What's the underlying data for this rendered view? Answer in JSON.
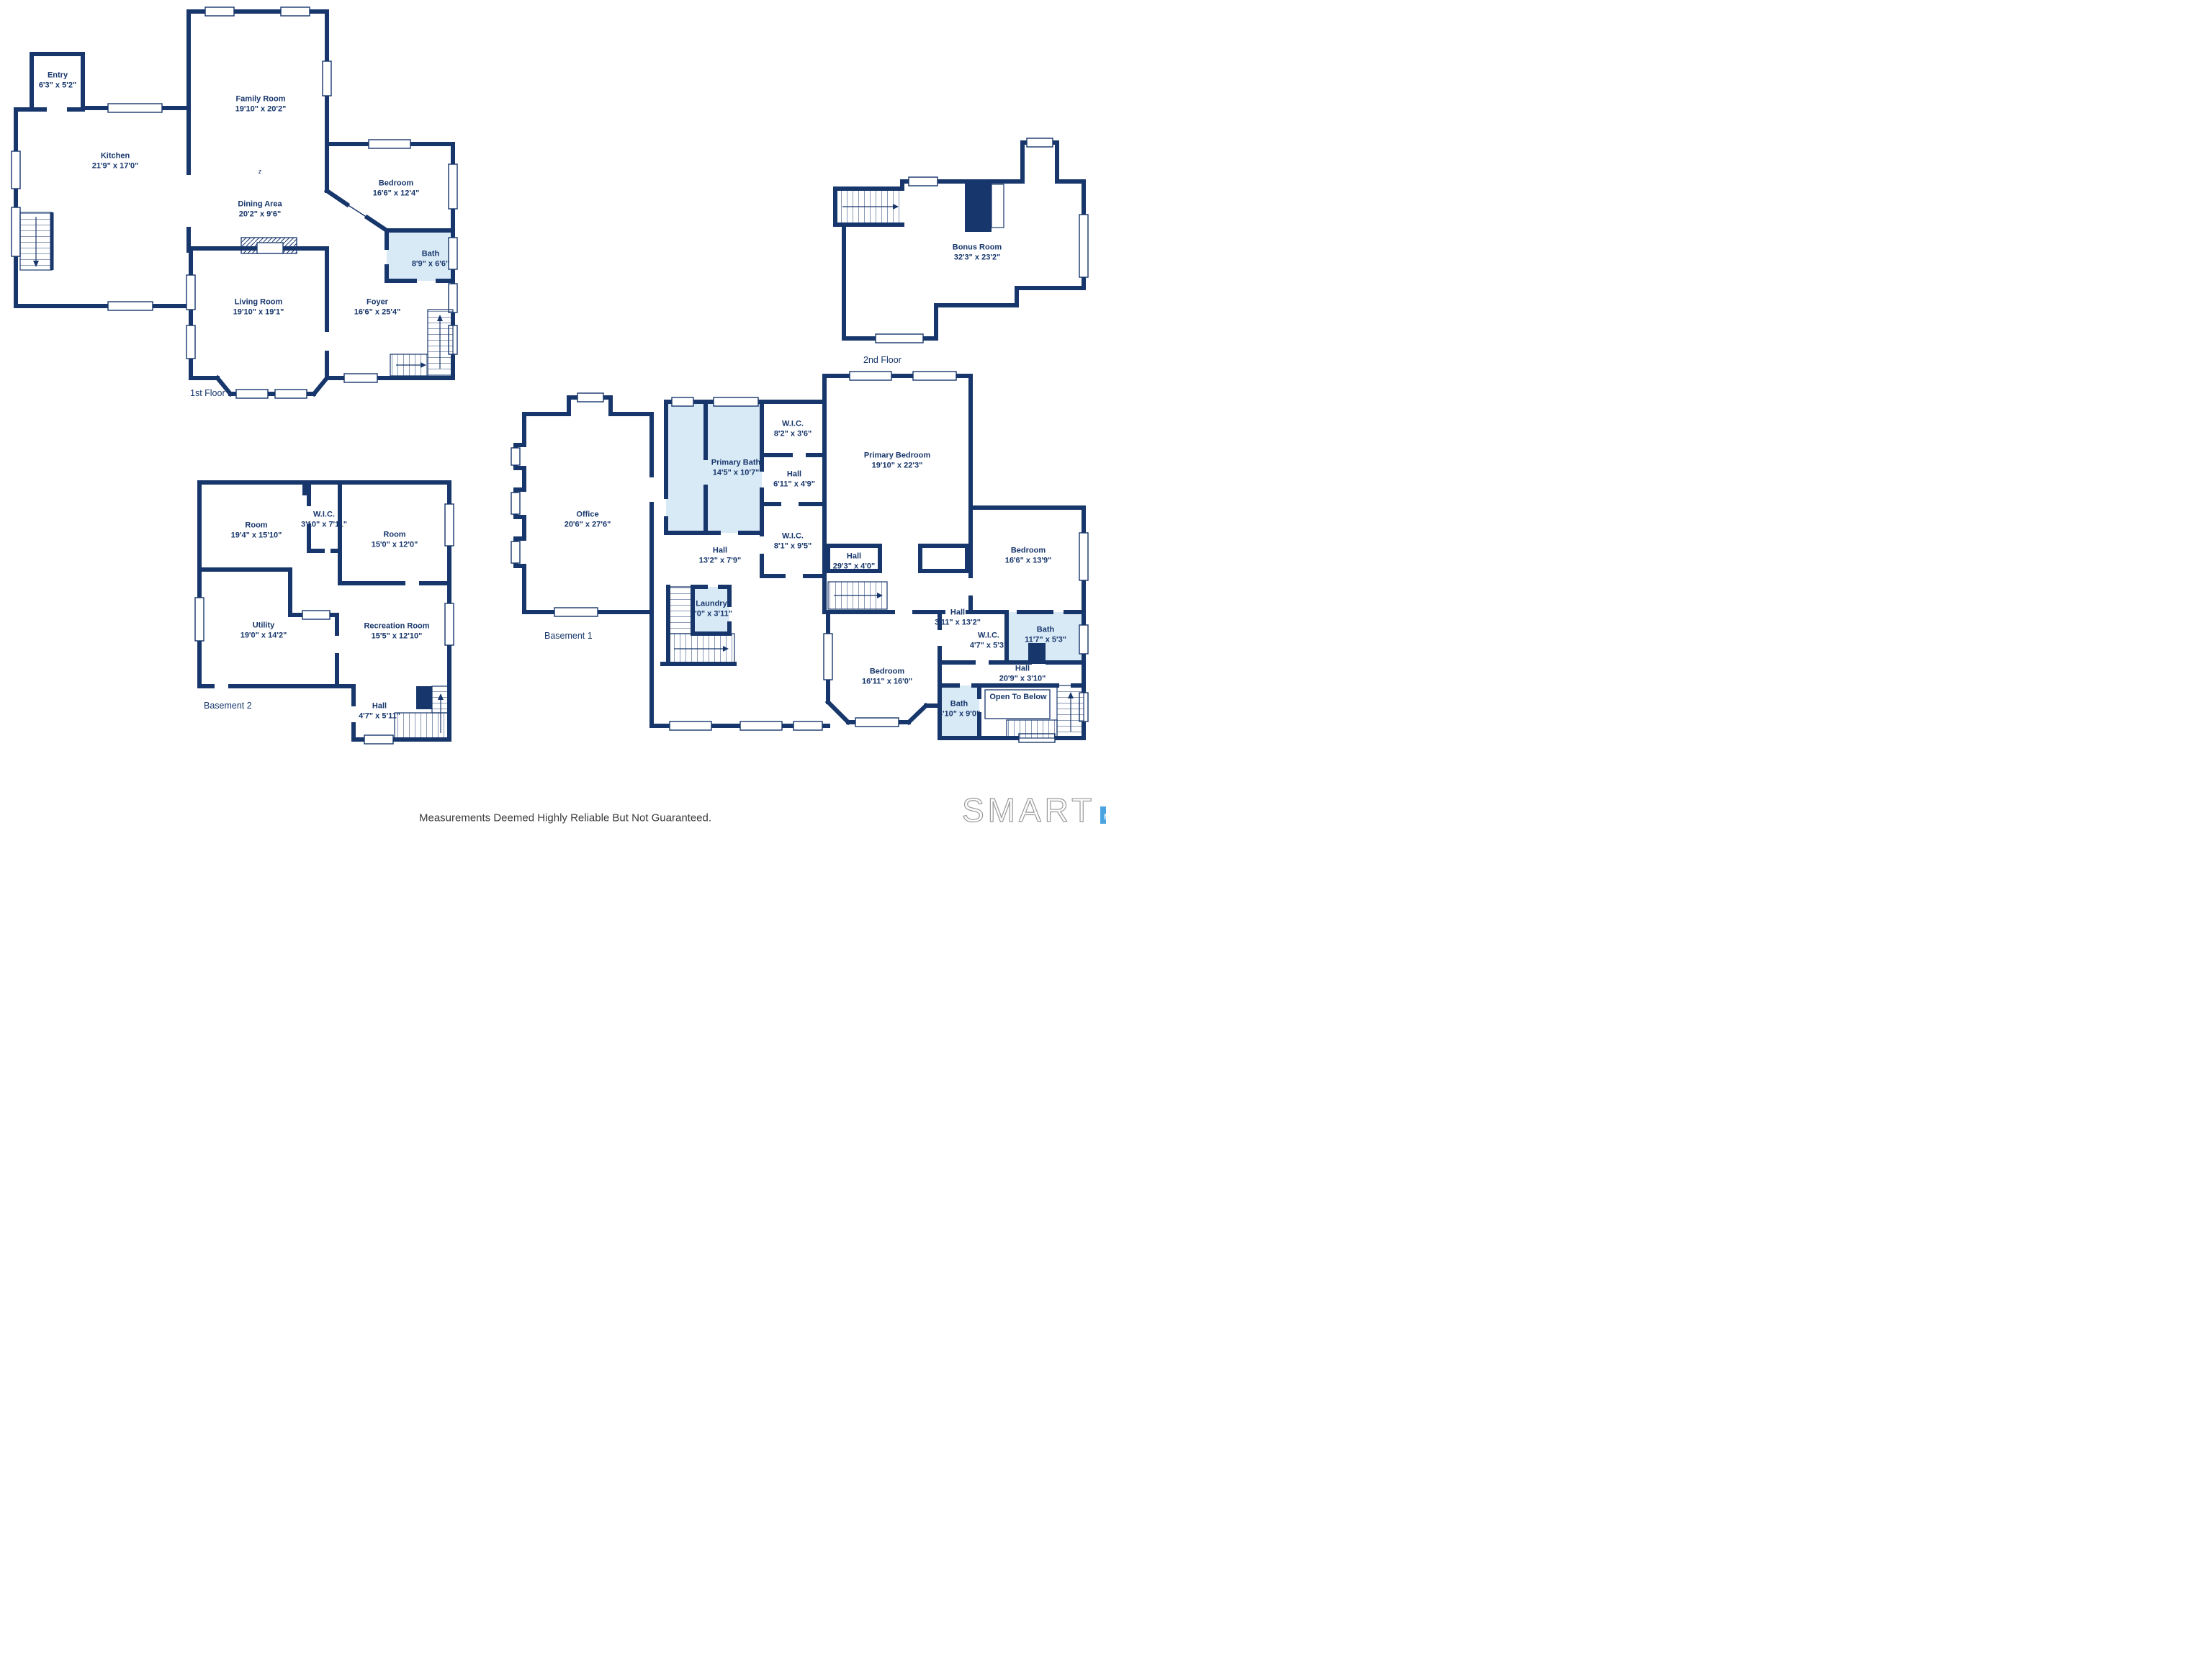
{
  "floors": [
    {
      "caption": "1st Floor",
      "rooms": [
        {
          "name": "Entry",
          "dims": "6'3\" x 5'2\""
        },
        {
          "name": "Kitchen",
          "dims": "21'9\" x 17'0\""
        },
        {
          "name": "Family Room",
          "dims": "19'10\" x 20'2\""
        },
        {
          "name": "Dining Area",
          "dims": "20'2\" x 9'6\""
        },
        {
          "name": "Bedroom",
          "dims": "16'6\" x 12'4\""
        },
        {
          "name": "Bath",
          "dims": "8'9\" x 6'6\""
        },
        {
          "name": "Foyer",
          "dims": "16'6\" x 25'4\""
        },
        {
          "name": "Living Room",
          "dims": "19'10\" x 19'1\""
        }
      ]
    },
    {
      "caption": "2nd Floor",
      "rooms": [
        {
          "name": "Bonus Room",
          "dims": "32'3\" x 23'2\""
        }
      ]
    },
    {
      "caption": "Basement 1",
      "rooms": [
        {
          "name": "Office",
          "dims": "20'6\" x 27'6\""
        },
        {
          "name": "Primary Bath",
          "dims": "14'5\" x 10'7\""
        },
        {
          "name": "W.I.C.",
          "dims": "8'2\" x 3'6\""
        },
        {
          "name": "Hall",
          "dims": "6'11\" x 4'9\""
        },
        {
          "name": "Primary Bedroom",
          "dims": "19'10\" x 22'3\""
        },
        {
          "name": "Hall",
          "dims": "13'2\" x 7'9\""
        },
        {
          "name": "W.I.C.",
          "dims": "8'1\" x 9'5\""
        },
        {
          "name": "Laundry",
          "dims": "5'0\" x 3'11\""
        },
        {
          "name": "Hall",
          "dims": "29'3\" x 4'0\""
        },
        {
          "name": "Bedroom",
          "dims": "16'6\" x 13'9\""
        },
        {
          "name": "Hall",
          "dims": "3'11\" x 13'2\""
        },
        {
          "name": "W.I.C.",
          "dims": "4'7\" x 5'3\""
        },
        {
          "name": "Bath",
          "dims": "11'7\" x 5'3\""
        },
        {
          "name": "Hall",
          "dims": "20'9\" x 3'10\""
        },
        {
          "name": "Bedroom",
          "dims": "16'11\" x 16'0\""
        },
        {
          "name": "Bath",
          "dims": "4'10\" x 9'0\""
        },
        {
          "name": "Open To Below",
          "dims": ""
        }
      ]
    },
    {
      "caption": "Basement 2",
      "rooms": [
        {
          "name": "Room",
          "dims": "19'4\" x 15'10\""
        },
        {
          "name": "W.I.C.",
          "dims": "3'10\" x 7'11\""
        },
        {
          "name": "Room",
          "dims": "15'0\" x 12'0\""
        },
        {
          "name": "Utility",
          "dims": "19'0\" x 14'2\""
        },
        {
          "name": "Recreation Room",
          "dims": "15'5\" x 12'10\""
        },
        {
          "name": "Hall",
          "dims": "4'7\" x 5'11\""
        }
      ]
    }
  ],
  "footer": {
    "disclaimer": "Measurements Deemed Highly Reliable But Not Guaranteed."
  },
  "brand": {
    "wordmark": "SMART",
    "bars": [
      "M",
      "L",
      "S"
    ]
  },
  "colors": {
    "wall": "#17366B",
    "bath_fill": "#D9EAF7",
    "label_text": "#17366B",
    "footer_text": "#3C3C3C",
    "bar_m": "#4BA4DF",
    "bar_l": "#1E6CB5",
    "bar_s": "#2E4B60",
    "wordmark_outline": "#9A9A9A"
  }
}
